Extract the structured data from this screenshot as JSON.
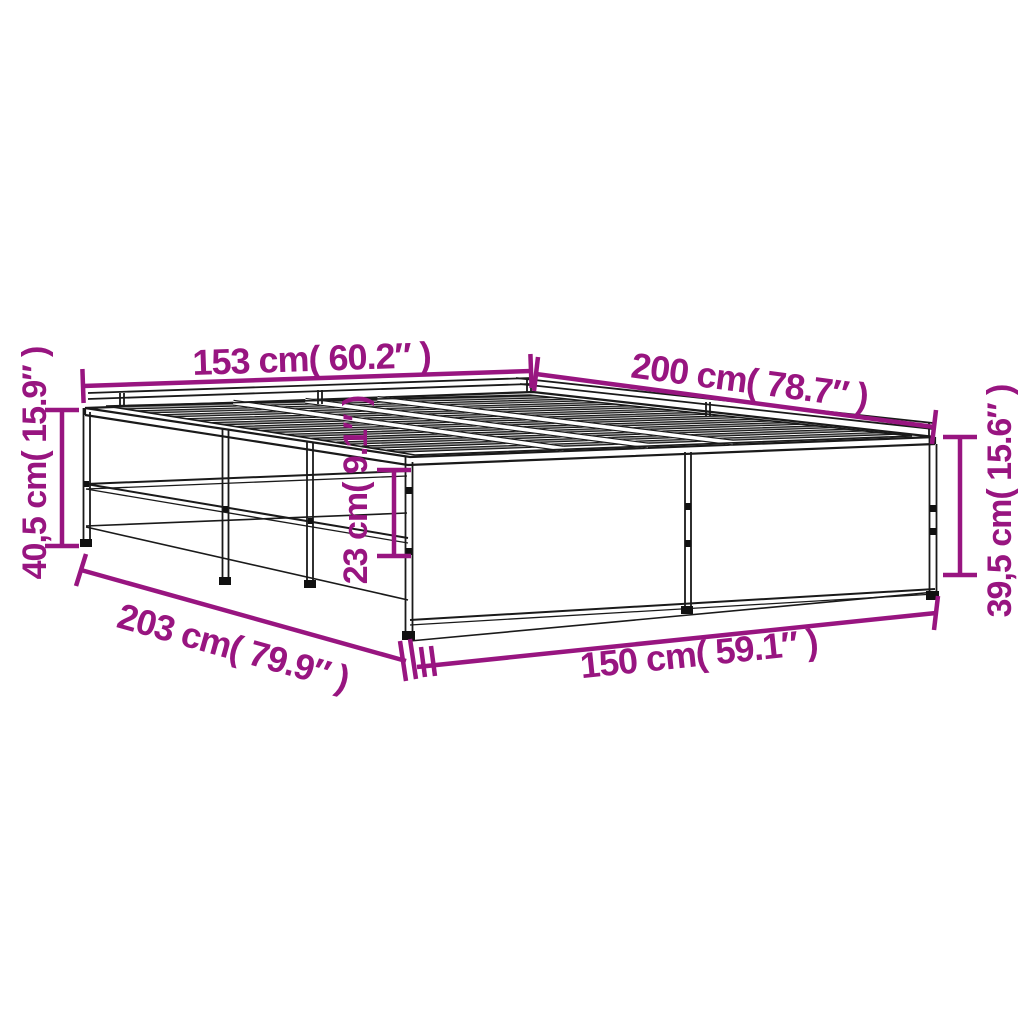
{
  "meta": {
    "description": "Product dimension line-drawing of a metal bed frame with wooden slats, shown in perspective on a white background",
    "background": "#ffffff",
    "accent_color": "#981580",
    "line_color": "#1a1a1a"
  },
  "dimensions": {
    "head_width": "153 cm( 60.2″ )",
    "top_length": "200 cm( 78.7″ )",
    "height_left": "40,5 cm( 15.9″ )",
    "rail_height": "23 cm( 9.1″ )",
    "height_right": "39,5 cm( 15.6″ )",
    "bottom_length": "203 cm( 79.9″ )",
    "foot_width": "150 cm( 59.1″ )"
  }
}
